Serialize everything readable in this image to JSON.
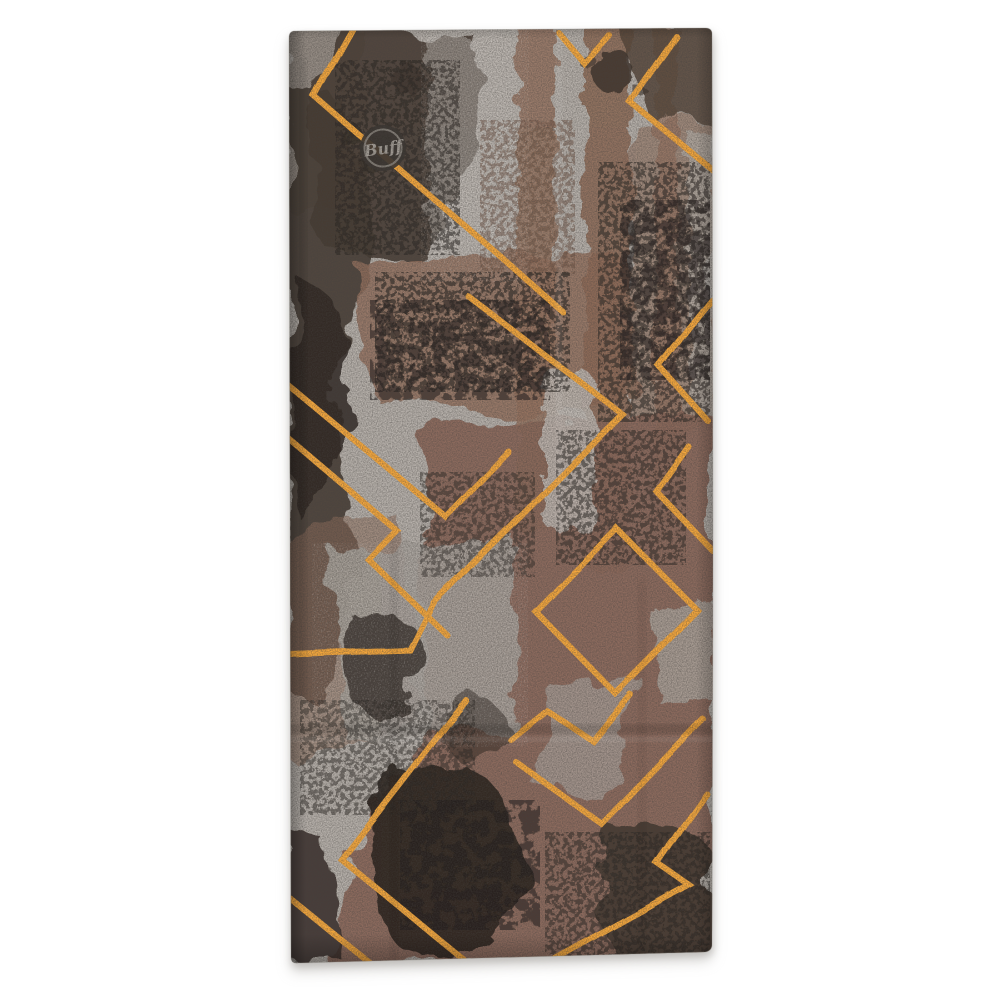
{
  "scene": {
    "type": "product-photo",
    "background_color": "#ffffff",
    "description": "Flat-lay product photo of a BUFF tubular neckwear gaiter printed with an abstract brown, grey and black grunge camo pattern overlaid with an orange geometric maze line motif and a circular Buff logo near the top left"
  },
  "product": {
    "brand": "BUFF",
    "category": "multifunctional tubular neckwear",
    "logo": {
      "text": "Buff",
      "shape": "script wordmark inside a dark circle with thin light ring"
    }
  },
  "palette": {
    "accent_orange": "#f6a83c",
    "base_grey": "#b7b1ab",
    "silver_grey": "#c3bdb7",
    "mid_brown": "#8b685a",
    "stripe_brown": "#96735f",
    "dark_umber": "#473d34",
    "near_black": "#2a241f",
    "logo_circle": "#3b3531",
    "logo_text_grey": "#a39d96"
  }
}
